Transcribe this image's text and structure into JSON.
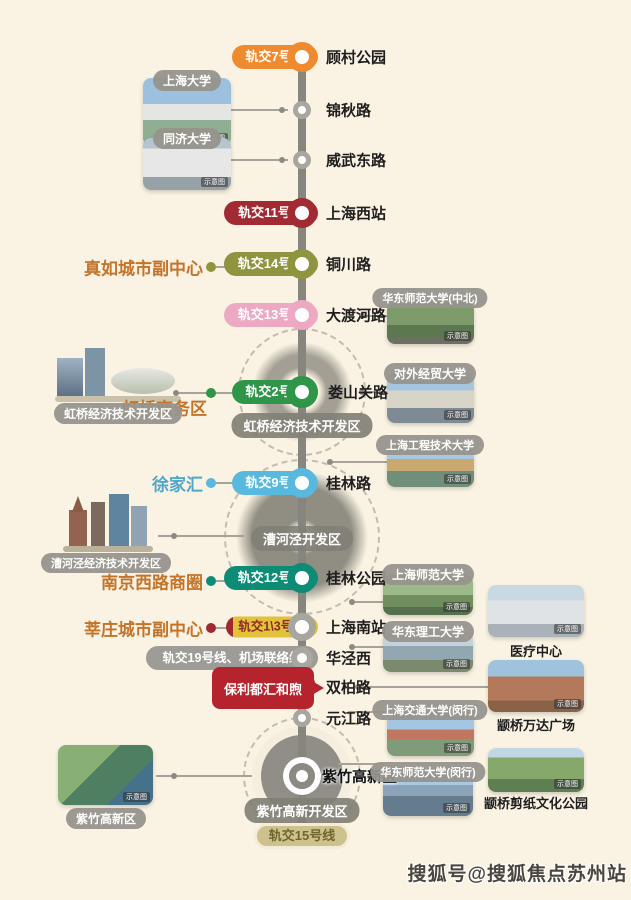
{
  "watermark": "搜狐号@搜狐焦点苏州站",
  "photo_tag": "示意图",
  "project": {
    "name": "保利都汇和煦"
  },
  "colors": {
    "background": "#FAF3E3",
    "main_line": "#87867E",
    "line7": "#EE8A2F",
    "line11": "#A12A33",
    "line14": "#8F953F",
    "line13": "#EDA9C4",
    "line2": "#2F9549",
    "line9": "#58B8DD",
    "line12": "#0D8C75",
    "line1_3": "#E2C23B",
    "line19": "#9D9C96",
    "line15": "#CDC18D",
    "project_red": "#B5242C",
    "area_label_orange": "#C3742B",
    "xujiahui_teal": "#4FA8CB"
  },
  "stations": [
    {
      "name": "顾村公园",
      "badge": "轨交7号线"
    },
    {
      "name": "锦秋路"
    },
    {
      "name": "威武东路"
    },
    {
      "name": "上海西站",
      "badge": "轨交11号线"
    },
    {
      "name": "铜川路",
      "badge": "轨交14号线"
    },
    {
      "name": "大渡河路",
      "badge": "轨交13号线"
    },
    {
      "name": "娄山关路",
      "badge": "轨交2号线"
    },
    {
      "name": "桂林路",
      "badge": "轨交9号线"
    },
    {
      "name": "桂林公园",
      "badge": "轨交12号线"
    },
    {
      "name": "上海南站",
      "badge": "轨交1\\3号线"
    },
    {
      "name": "华泾西",
      "badge": "轨交19号线、机场联络线"
    },
    {
      "name": "双柏路"
    },
    {
      "name": "元江路"
    },
    {
      "name": "紫竹高新区",
      "badge": "轨交15号线"
    }
  ],
  "areas": [
    {
      "name": "真如城市副中心"
    },
    {
      "name": "虹桥商务区"
    },
    {
      "name": "徐家汇"
    },
    {
      "name": "南京西路商圈"
    },
    {
      "name": "莘庄城市副中心"
    }
  ],
  "hubs": [
    {
      "label": "虹桥经济技术开发区"
    },
    {
      "label": "漕河泾开发区"
    },
    {
      "label": "紫竹高新开发区"
    }
  ],
  "photos": {
    "left": [
      {
        "label": "上海大学"
      },
      {
        "label": "同济大学"
      }
    ],
    "collages": [
      {
        "label": "虹桥经济技术开发区"
      },
      {
        "label": "漕河泾经济技术开发区"
      },
      {
        "label": "紫竹高新区"
      }
    ],
    "right": [
      {
        "label": "华东师范大学(中北)"
      },
      {
        "label": "对外经贸大学"
      },
      {
        "label": "上海工程技术大学"
      },
      {
        "label": "上海师范大学"
      },
      {
        "label": "华东理工大学"
      },
      {
        "label": "上海交通大学(闵行)"
      },
      {
        "label": "华东师范大学(闵行)"
      }
    ],
    "poi": [
      {
        "label": "医疗中心"
      },
      {
        "label": "颛桥万达广场"
      },
      {
        "label": "颛桥剪纸文化公园"
      }
    ]
  }
}
